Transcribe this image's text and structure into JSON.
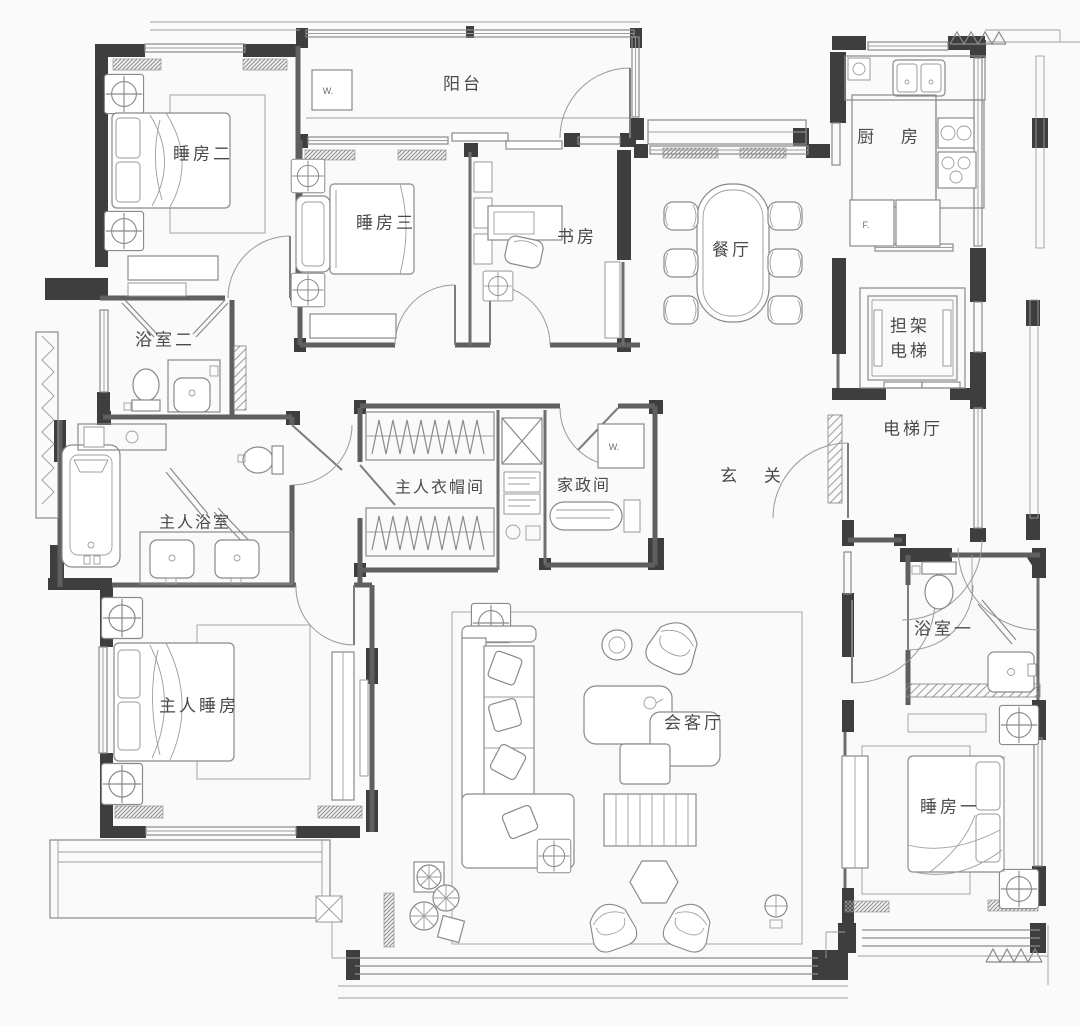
{
  "palette": {
    "background": "#fafafa",
    "wall_dark": "#3e3e3e",
    "wall": "#5f5f5f",
    "line": "#8a8a8a",
    "label_text": "#4a4a4a"
  },
  "rooms": {
    "balcony": "阳台",
    "bedroom2": "睡房二",
    "bedroom3": "睡房三",
    "study": "书房",
    "dining_room": "餐厅",
    "kitchen": "厨 房",
    "stretcher_elevator": "担架\n电梯",
    "elevator_hall": "电梯厅",
    "foyer": "玄 关",
    "bathroom2": "浴室二",
    "master_bathroom": "主人浴室",
    "master_closet": "主人衣帽间",
    "housekeeping_room": "家政间",
    "master_bedroom": "主人睡房",
    "living_room": "会客厅",
    "bathroom1": "浴室一",
    "bedroom1": "睡房一"
  },
  "annotations": {
    "fridge": "F.",
    "balcony_unit": "W.",
    "housekeeping_unit": "W."
  }
}
